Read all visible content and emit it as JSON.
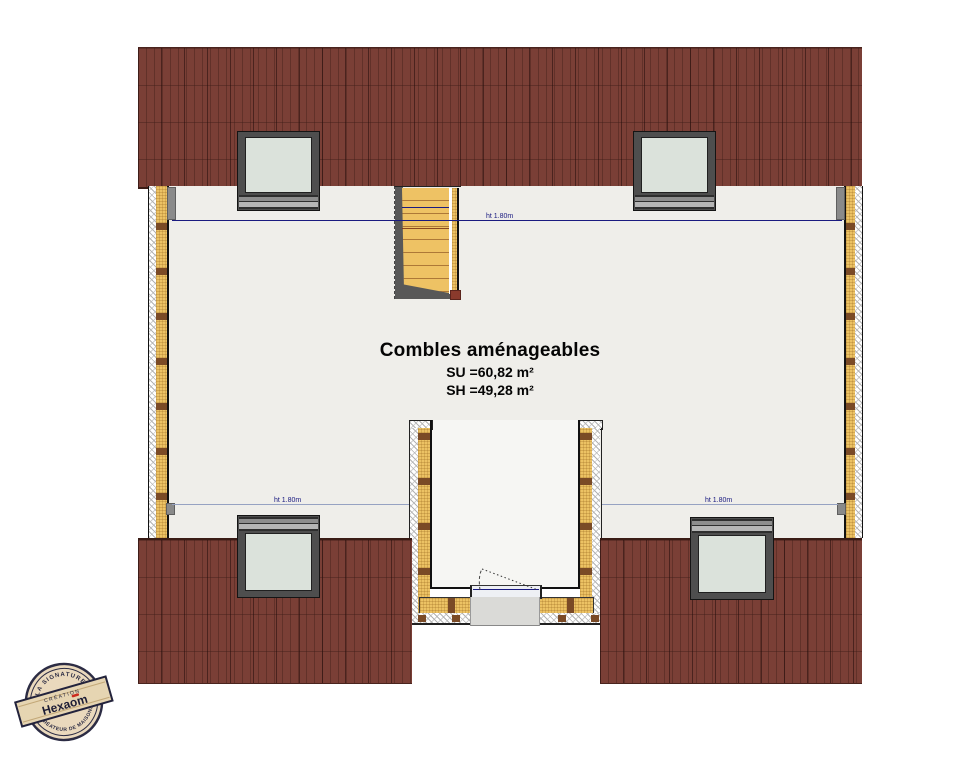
{
  "plan": {
    "title": "Combles aménageables",
    "surface_utile": "SU =60,82 m²",
    "surface_habitable": "SH =49,28 m²",
    "height_lines": {
      "top": "ht 1.80m",
      "bottom_left": "ht 1.80m",
      "bottom_right": "ht 1.80m"
    },
    "colors": {
      "roof": "#7a3f36",
      "floor": "#efeeea",
      "insulation": "#ecc264",
      "stud": "#7a4a26",
      "glass": "#dbe2db",
      "window_frame": "#4e4e4e",
      "height_line": "#1a1a80",
      "stair_treads": "#eec264"
    }
  },
  "logo": {
    "arc_top": "LA SIGNATURE",
    "arc_bottom": "CRÉATEUR DE MAISONS",
    "banner_small": "CRÉATION",
    "brand_prefix": "Hexa",
    "brand_accent": "o",
    "brand_suffix": "m",
    "accent_color": "#cc2b1e"
  }
}
